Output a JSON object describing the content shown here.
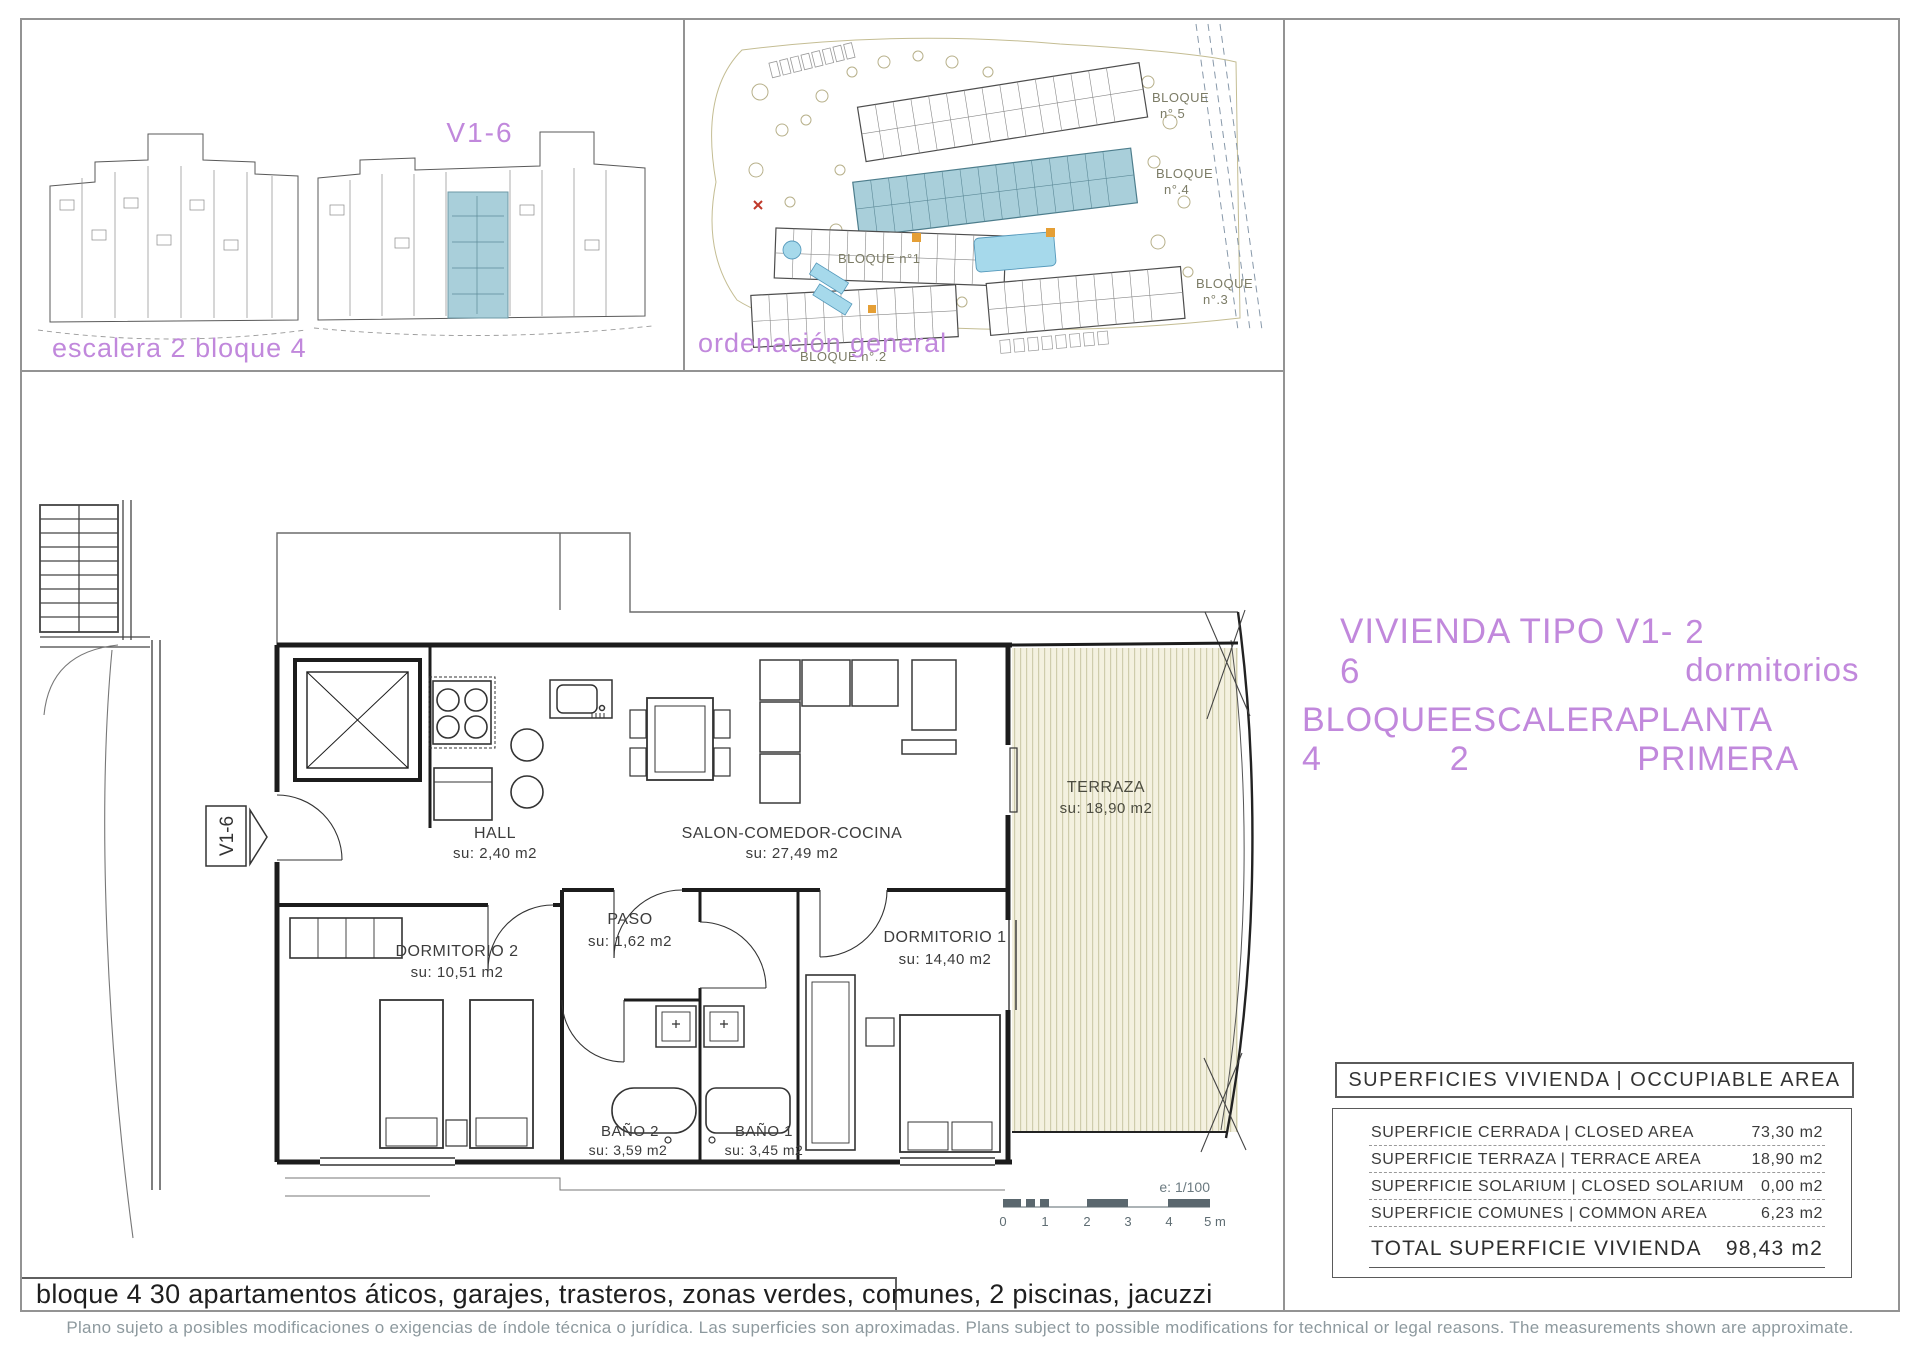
{
  "colors": {
    "accent_purple": "#c188dc",
    "highlight_teal": "#a9cfda",
    "pool_blue": "#a6d9eb",
    "terraza_beige": "#f4f1e0",
    "terraza_stripe": "#cfccac",
    "site_olive": "#b7b08a",
    "footer_gray": "#8d999e"
  },
  "key_plan": {
    "unit_code": "V1-6",
    "caption": "escalera 2 bloque 4"
  },
  "site_plan": {
    "caption": "ordenación general",
    "b5_l1": "BLOQUE",
    "b5_l2": "n°.5",
    "b4_l1": "BLOQUE",
    "b4_l2": "n°.4",
    "b1": "BLOQUE n°1",
    "b2": "BLOQUE n°.2",
    "b3_l1": "BLOQUE",
    "b3_l2": "n°.3"
  },
  "title": {
    "line1_left": "VIVIENDA TIPO V1-6",
    "line1_right": "2 dormitorios",
    "line2_parts": [
      "BLOQUE 4",
      "ESCALERA 2",
      "PLANTA PRIMERA"
    ]
  },
  "plan": {
    "entry_tag": "V1-6",
    "hall": {
      "name": "HALL",
      "su": "su: 2,40 m2"
    },
    "salon": {
      "name": "SALON-COMEDOR-COCINA",
      "su": "su: 27,49 m2"
    },
    "terraza": {
      "name": "TERRAZA",
      "su": "su: 18,90 m2"
    },
    "dorm2": {
      "name": "DORMITORIO 2",
      "su": "su: 10,51 m2"
    },
    "paso": {
      "name": "PASO",
      "su": "su: 1,62 m2"
    },
    "dorm1": {
      "name": "DORMITORIO 1",
      "su": "su: 14,40 m2"
    },
    "bano2": {
      "name": "BAÑO 2",
      "su": "su: 3,59 m2"
    },
    "bano1": {
      "name": "BAÑO 1",
      "su": "su: 3,45 m2"
    },
    "scale": {
      "label": "e: 1/100",
      "t0": "0",
      "t1": "1",
      "t2": "2",
      "t3": "3",
      "t4": "4",
      "t5": "5 m"
    }
  },
  "table": {
    "header": "SUPERFICIES VIVIENDA | OCCUPIABLE AREA",
    "rows": [
      {
        "label": "SUPERFICIE CERRADA | CLOSED AREA",
        "value": "73,30 m2"
      },
      {
        "label": "SUPERFICIE TERRAZA | TERRACE AREA",
        "value": "18,90 m2"
      },
      {
        "label": "SUPERFICIE SOLARIUM | CLOSED SOLARIUM",
        "value": "0,00 m2"
      },
      {
        "label": "SUPERFICIE COMUNES | COMMON AREA",
        "value": "6,23 m2"
      }
    ],
    "total_label": "TOTAL SUPERFICIE VIVIENDA",
    "total_value": "98,43 m2"
  },
  "bottom_bar": "bloque 4 30 apartamentos áticos, garajes, trasteros, zonas verdes, comunes, 2 piscinas, jacuzzi",
  "footer": "Plano sujeto a posibles modificaciones o exigencias de índole técnica o jurídica. Las superficies son aproximadas. Plans subject to possible modifications for technical or legal reasons. The measurements shown are approximate."
}
